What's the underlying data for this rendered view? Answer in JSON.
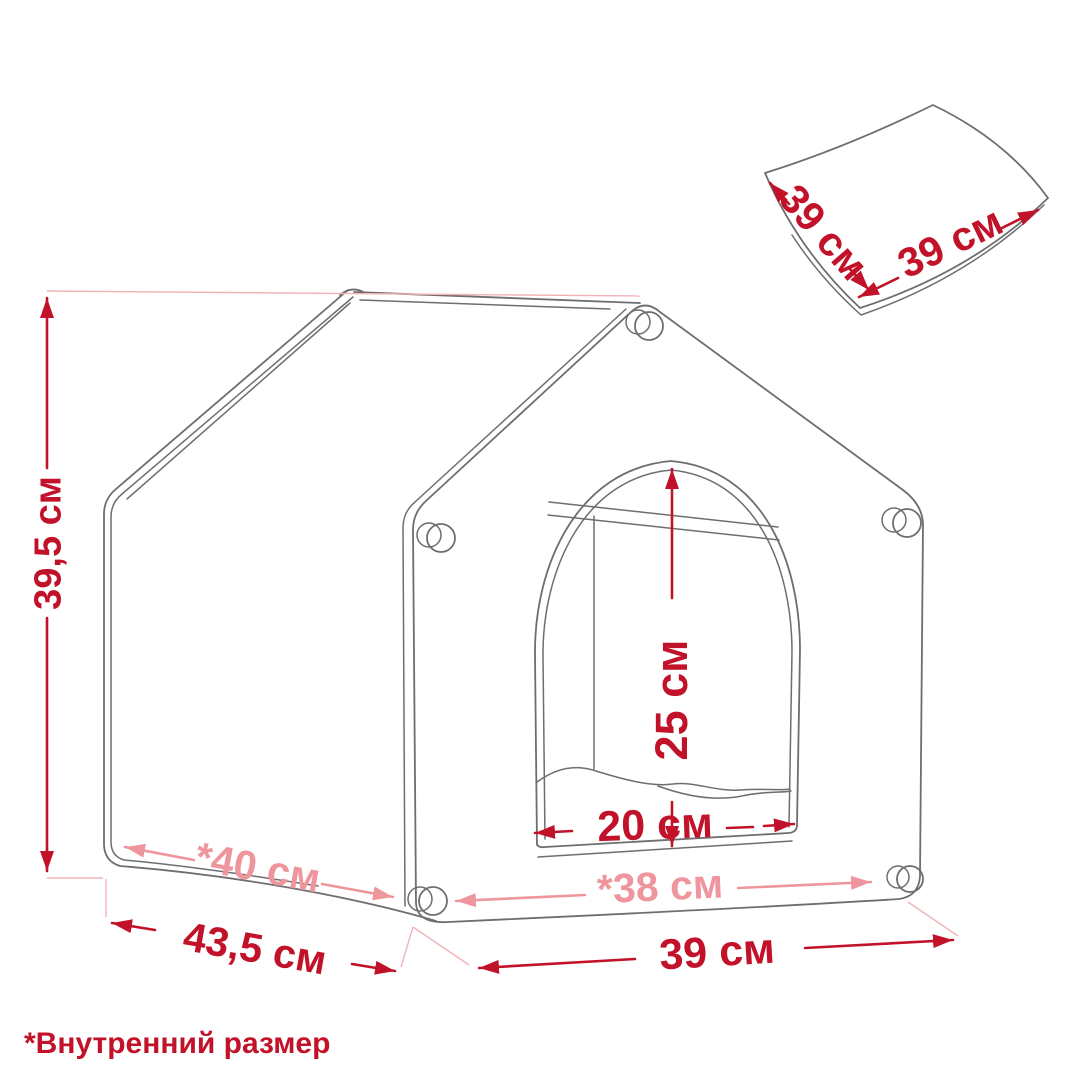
{
  "diagram": {
    "title_semantic": "pet-house-dimensions",
    "colors": {
      "dimension_red": "#c2122a",
      "dimension_pink": "#ef959d",
      "extension_pink": "#f2b3b8",
      "line_gray": "#6e6e70"
    },
    "house": {
      "height": "39,5 см",
      "depth_outer": "43,5 см",
      "depth_inner": "*40 см",
      "width_outer": "39 см",
      "width_inner": "*38 см",
      "door_height": "25 см",
      "door_width": "20 см"
    },
    "cushion": {
      "side_a": "39 см",
      "side_b": "39 см"
    },
    "footnote": "*Внутренний размер"
  }
}
